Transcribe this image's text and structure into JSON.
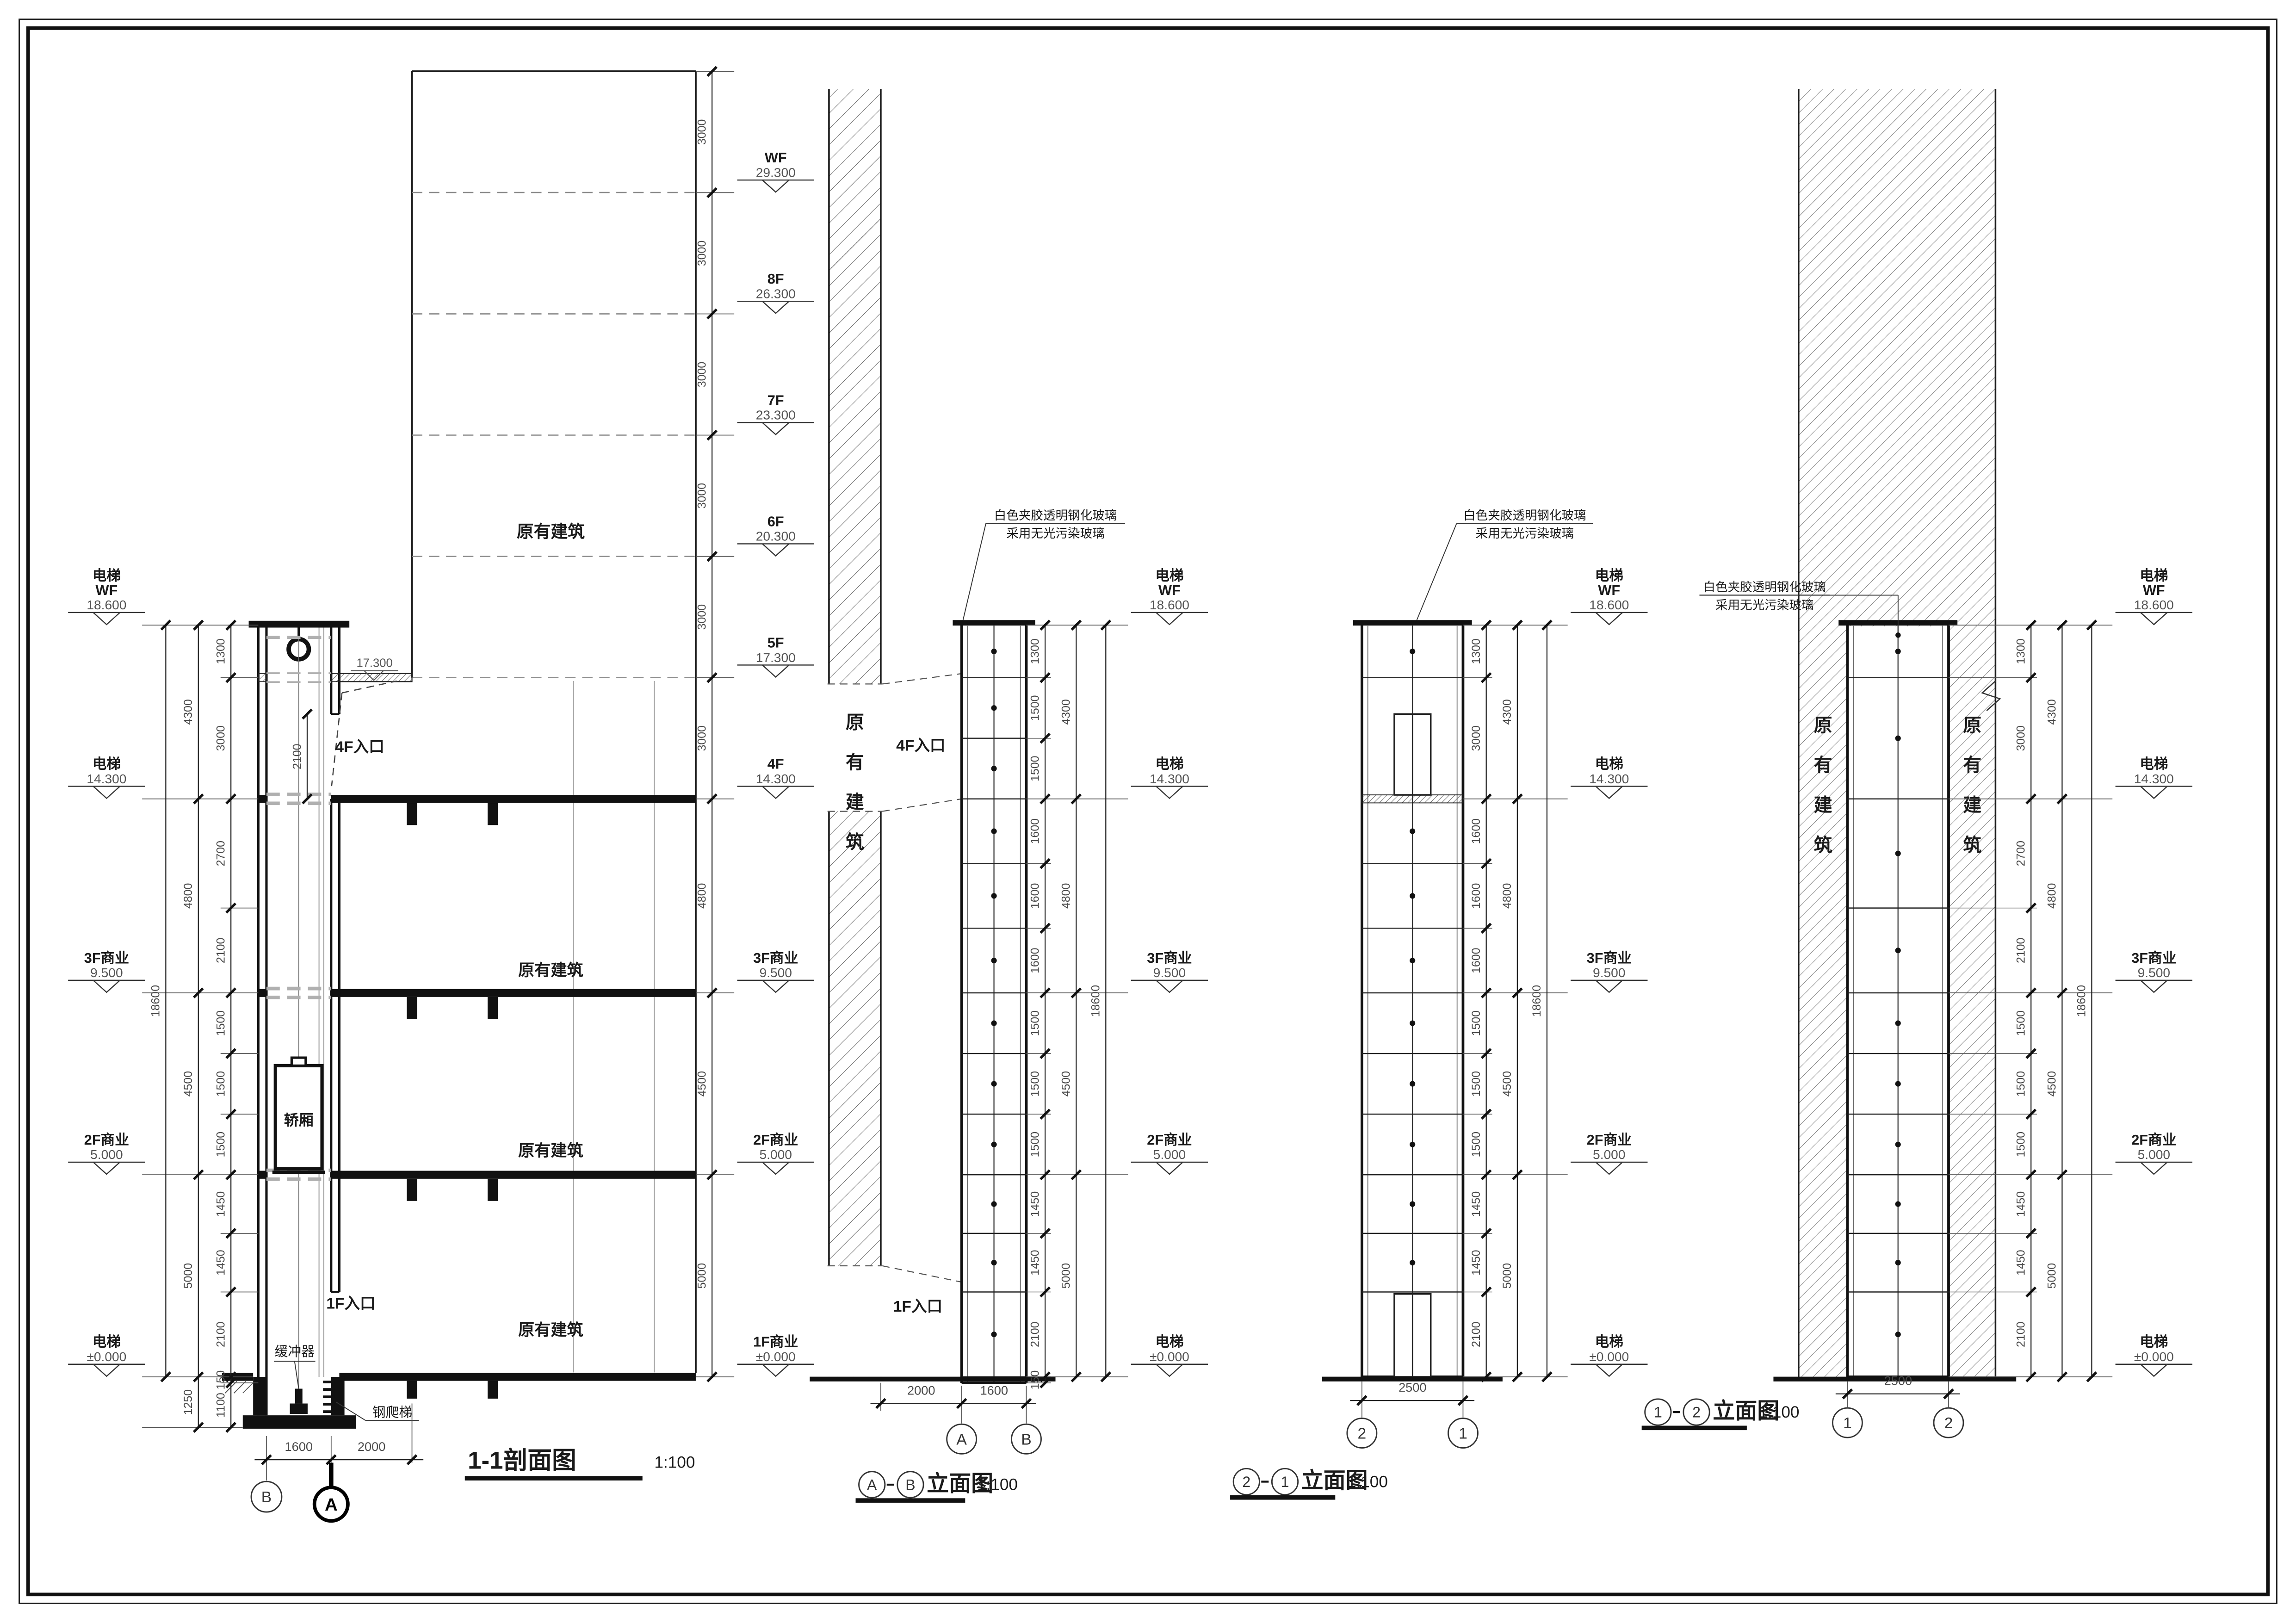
{
  "sheet": {
    "background": "#ffffff",
    "border_color": "#111111"
  },
  "shared": {
    "scale_label": "1:100",
    "glass_note": [
      "白色夹胶透明钢化玻璃",
      "采用无光污染玻璃"
    ],
    "existing_building": "原有建筑",
    "overall_dim": 18600,
    "mid_dims": [
      4300,
      4800,
      4500,
      5000
    ],
    "elevator_levels": [
      {
        "name": "电梯",
        "sub": "WF",
        "value": "18.600",
        "mm": 18600
      },
      {
        "name": "电梯",
        "value": "14.300",
        "mm": 14300
      },
      {
        "name": "3F商业",
        "value": "9.500",
        "mm": 9500
      },
      {
        "name": "2F商业",
        "value": "5.000",
        "mm": 5000
      },
      {
        "name": "电梯",
        "value": "±0.000",
        "mm": 0
      }
    ]
  },
  "section": {
    "title": "1-1剖面图",
    "right_levels": [
      {
        "name": "WF",
        "value": "29.300",
        "mm": 29300
      },
      {
        "name": "8F",
        "value": "26.300",
        "mm": 26300
      },
      {
        "name": "7F",
        "value": "23.300",
        "mm": 23300
      },
      {
        "name": "6F",
        "value": "20.300",
        "mm": 20300
      },
      {
        "name": "5F",
        "value": "17.300",
        "mm": 17300
      },
      {
        "name": "4F",
        "value": "14.300",
        "mm": 14300
      },
      {
        "name": "3F商业",
        "value": "9.500",
        "mm": 9500
      },
      {
        "name": "2F商业",
        "value": "5.000",
        "mm": 5000
      },
      {
        "name": "1F商业",
        "value": "±0.000",
        "mm": 0
      }
    ],
    "right_chain": [
      3000,
      3000,
      3000,
      3000,
      3000,
      3000,
      4800,
      4500,
      5000
    ],
    "left_mid": [
      4300,
      4800,
      4500,
      5000,
      1250
    ],
    "left_inner": [
      1300,
      3000,
      2700,
      2100,
      1500,
      1500,
      1500,
      1450,
      1450,
      2100,
      150,
      1100
    ],
    "labels": {
      "car": "轿厢",
      "buffer": "缓冲器",
      "ladder": "钢爬梯",
      "entry_4f": "4F入口",
      "entry_1f": "1F入口",
      "overrun": "17.300",
      "door_dim": 2100
    },
    "bottom_dims": [
      1600,
      2000
    ],
    "bubbles": [
      "B",
      "A"
    ]
  },
  "elev_ab": {
    "bubbles": [
      "A",
      "B"
    ],
    "type_label": "立面图",
    "panels": [
      1300,
      1500,
      1500,
      1600,
      1600,
      1600,
      1500,
      1500,
      1500,
      1450,
      1450,
      2100,
      150
    ],
    "bottom_dims": [
      2000,
      1600
    ],
    "entry_4f": "4F入口",
    "entry_1f": "1F入口"
  },
  "elev_21": {
    "bubbles": [
      "2",
      "1"
    ],
    "type_label": "立面图",
    "panels": [
      1300,
      3000,
      1600,
      1600,
      1600,
      1500,
      1500,
      1500,
      1450,
      1450,
      2100
    ],
    "bottom_dims": [
      2500
    ]
  },
  "elev_12": {
    "bubbles": [
      "1",
      "2"
    ],
    "type_label": "立面图",
    "panels": [
      1300,
      3000,
      2700,
      2100,
      1500,
      1500,
      1500,
      1450,
      1450,
      2100
    ],
    "bottom_dims": [
      2500
    ]
  }
}
